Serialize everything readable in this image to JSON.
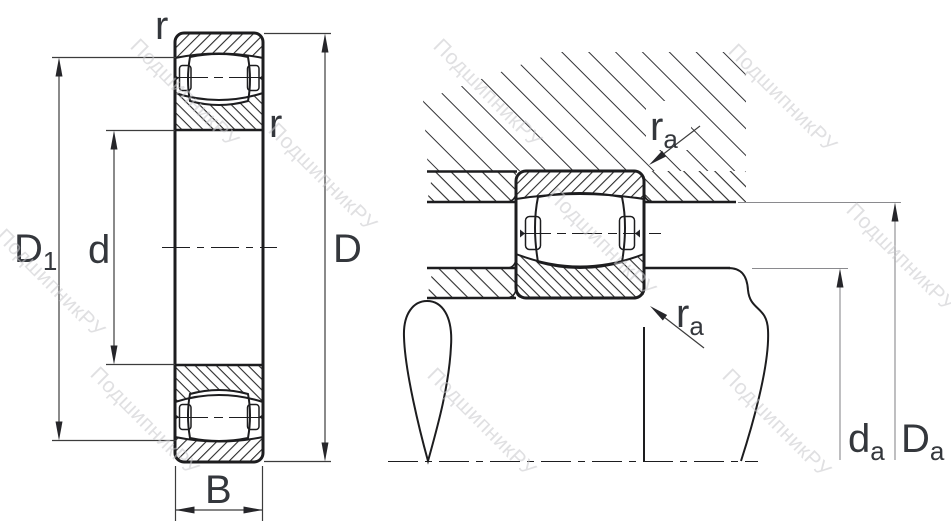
{
  "drawing": {
    "type": "bearing-technical-drawing",
    "views": [
      "cross-section",
      "mounting-abutment"
    ]
  },
  "labels": {
    "r_top": "r",
    "r_inner": "r",
    "D1_base": "D",
    "D1_sub": "1",
    "d": "d",
    "D": "D",
    "B": "B",
    "ra_top_base": "r",
    "ra_top_sub": "a",
    "ra_bottom_base": "r",
    "ra_bottom_sub": "a",
    "da_base": "d",
    "da_sub": "a",
    "Da_base": "D",
    "Da_sub": "a"
  },
  "watermark": {
    "text": "ПодшипникРУ",
    "color": "#c7c7cb"
  },
  "colors": {
    "line": "#1d1d1f",
    "hatch": "#2b2b2b",
    "dimension": "#3c3c3c",
    "dimension_light": "#8a8a8e",
    "label": "#34373c",
    "background": "#ffffff"
  }
}
